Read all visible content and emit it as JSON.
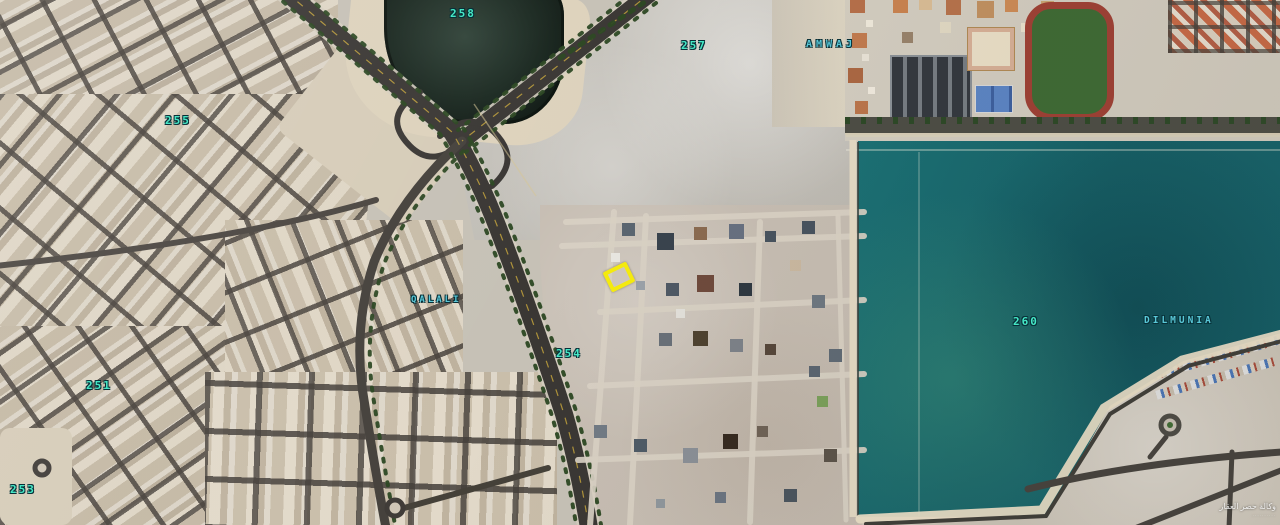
{
  "map": {
    "title": "satellite-map-qalali-amwaj-dilmunia",
    "labels": {
      "block_258": "258",
      "block_257": "257",
      "block_255": "255",
      "block_254": "254",
      "block_251": "251",
      "block_253": "253",
      "block_260": "260",
      "amwaj": "AMWAJ",
      "qalali": "QALALI",
      "dilmunia": "DILMUNIA"
    },
    "marker": {
      "label": "highlighted-plot",
      "color": "#f4ea0e"
    },
    "watermark": {
      "line1": "وكالة حصر العقار",
      "line2": "··········"
    },
    "colors": {
      "label_numbers": "#45e8c6",
      "label_places": "#5ac8d8",
      "lagoon_water": "#15696e",
      "pond_water": "#1a2a20",
      "highway": "#3a3734",
      "sand": "#c6c1b6",
      "dirt_road": "#d8d0c3",
      "track_red": "#9e4034",
      "grass": "#3d6a33"
    }
  }
}
